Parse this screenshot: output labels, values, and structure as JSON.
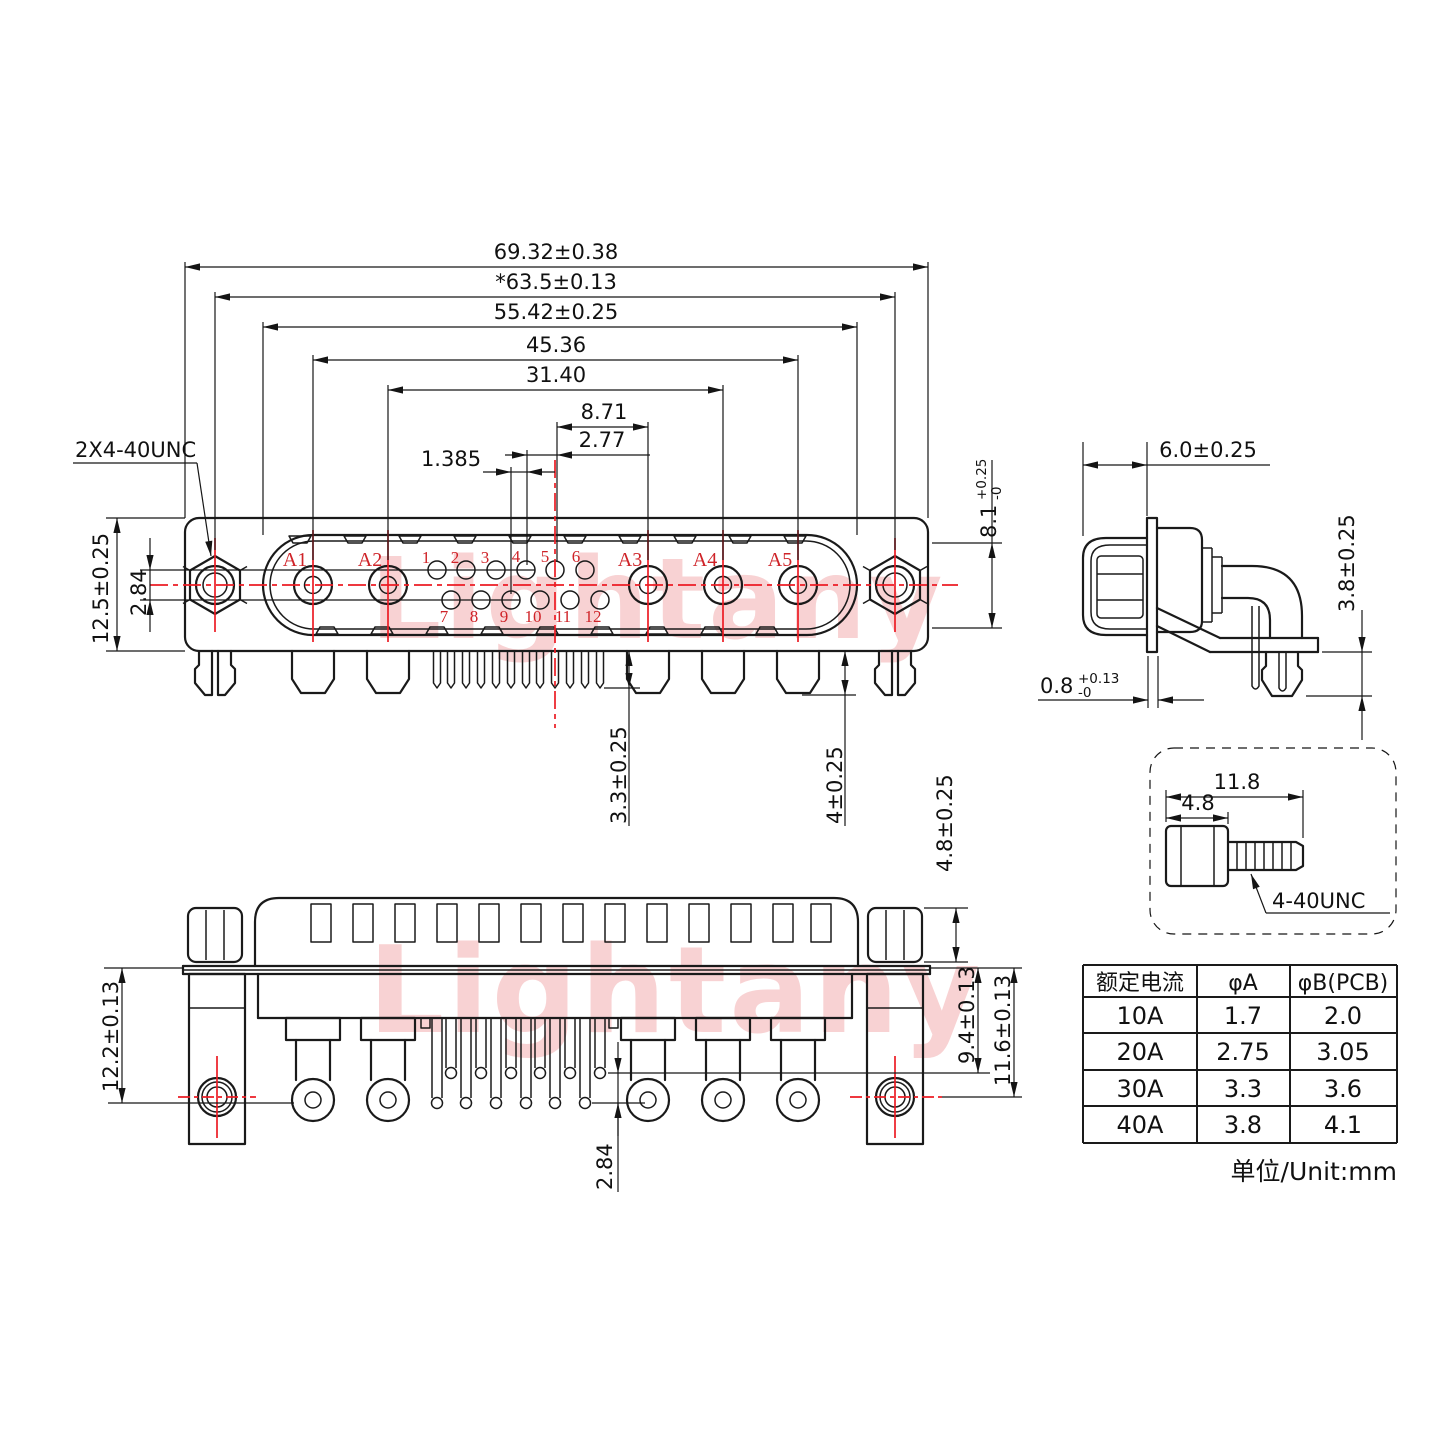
{
  "watermark": {
    "text": "Lightany"
  },
  "front_view": {
    "thread_callout": "2X4-40UNC",
    "dim_overall_width": "69.32±0.38",
    "dim_mount_span": "*63.5±0.13",
    "dim_shell_width": "55.42±0.25",
    "dim_a1_a5_span": "45.36",
    "dim_a2_a4_span": "31.40",
    "dim_center_to_a3": "8.71",
    "dim_pin_pitch": "2.77",
    "dim_half_pitch": "1.385",
    "dim_body_height": "12.5±0.25",
    "dim_row_offset": "2.84",
    "dim_shell_height": {
      "value": "8.1",
      "plus": "+0.25",
      "minus": "-0"
    },
    "dim_coax_pin_length": "4±0.25",
    "dim_signal_pin_length": "3.3±0.25",
    "coax_labels": [
      "A1",
      "A2",
      "A3",
      "A4",
      "A5"
    ],
    "pin_numbers_top": [
      "1",
      "2",
      "3",
      "4",
      "5",
      "6"
    ],
    "pin_numbers_bottom": [
      "7",
      "8",
      "9",
      "10",
      "11",
      "12"
    ]
  },
  "side_view": {
    "dim_front_depth": "6.0±0.25",
    "dim_flange_thickness": {
      "value": "0.8",
      "plus": "+0.13",
      "minus": "-0"
    },
    "dim_pin_protrusion": "3.8±0.25"
  },
  "bottom_view": {
    "dim_bracket_to_long_pins": "12.2±0.13",
    "dim_plate_to_short_pins": "9.4±0.13",
    "dim_plate_to_holes": "11.6±0.13",
    "dim_pin_row_offset": "2.84",
    "dim_standoff_height": "4.8±0.25"
  },
  "screw_detail": {
    "dim_total_length": "11.8",
    "dim_body_length": "4.8",
    "thread_label": "4-40UNC"
  },
  "spec_table": {
    "headers": [
      "额定电流",
      "φA",
      "φB(PCB)"
    ],
    "rows": [
      [
        "10A",
        "1.7",
        "2.0"
      ],
      [
        "20A",
        "2.75",
        "3.05"
      ],
      [
        "30A",
        "3.3",
        "3.6"
      ],
      [
        "40A",
        "3.8",
        "4.1"
      ]
    ],
    "unit_note": "单位/Unit:mm"
  }
}
